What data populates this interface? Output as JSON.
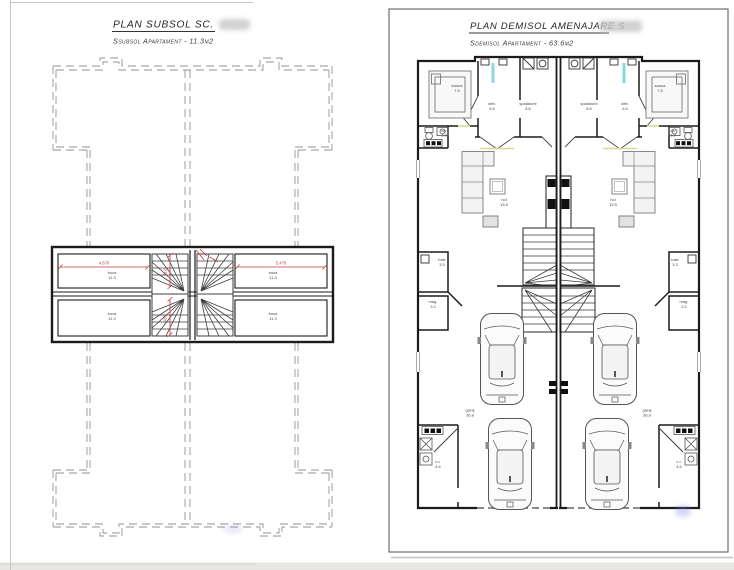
{
  "left_panel": {
    "title": "PLAN SUBSOL SC.",
    "subtitle": "Ssubsol Apartament - 11.3m2",
    "room": {
      "name": "boxa",
      "area": "11.3"
    },
    "dims": {
      "h_left": "4,670",
      "h_right": "5,470",
      "v_top": "110",
      "v_bottom": "455"
    }
  },
  "right_panel": {
    "title": "PLAN DEMISOL AMENAJARE S",
    "subtitle": "Sdemisol Apartament - 63.6m2",
    "rooms": {
      "sauna": {
        "name": "sauna",
        "area": "7.5"
      },
      "deb": {
        "name": "deb.",
        "area": "5.6"
      },
      "spalatorie": {
        "name": "spalatorie",
        "area": "8.6"
      },
      "wc": {
        "name": "wc",
        "area": "1.9"
      },
      "hol": {
        "name": "hol",
        "area": "15.5"
      },
      "baie": {
        "name": "baie",
        "area": "3.3"
      },
      "mag": {
        "name": "mag.",
        "area": "3.2"
      },
      "garaj": {
        "name": "garaj",
        "area": "36.8"
      },
      "ct": {
        "name": "c.t.",
        "area": "4.6"
      }
    }
  },
  "colors": {
    "wall": "#1b1b1b",
    "dashed_outline": "#929292",
    "dimension_red": "#c23b3b",
    "skylight_cyan": "#8fd4e4",
    "threshold_yellow": "#d6d98e",
    "paper": "#ffffff"
  }
}
